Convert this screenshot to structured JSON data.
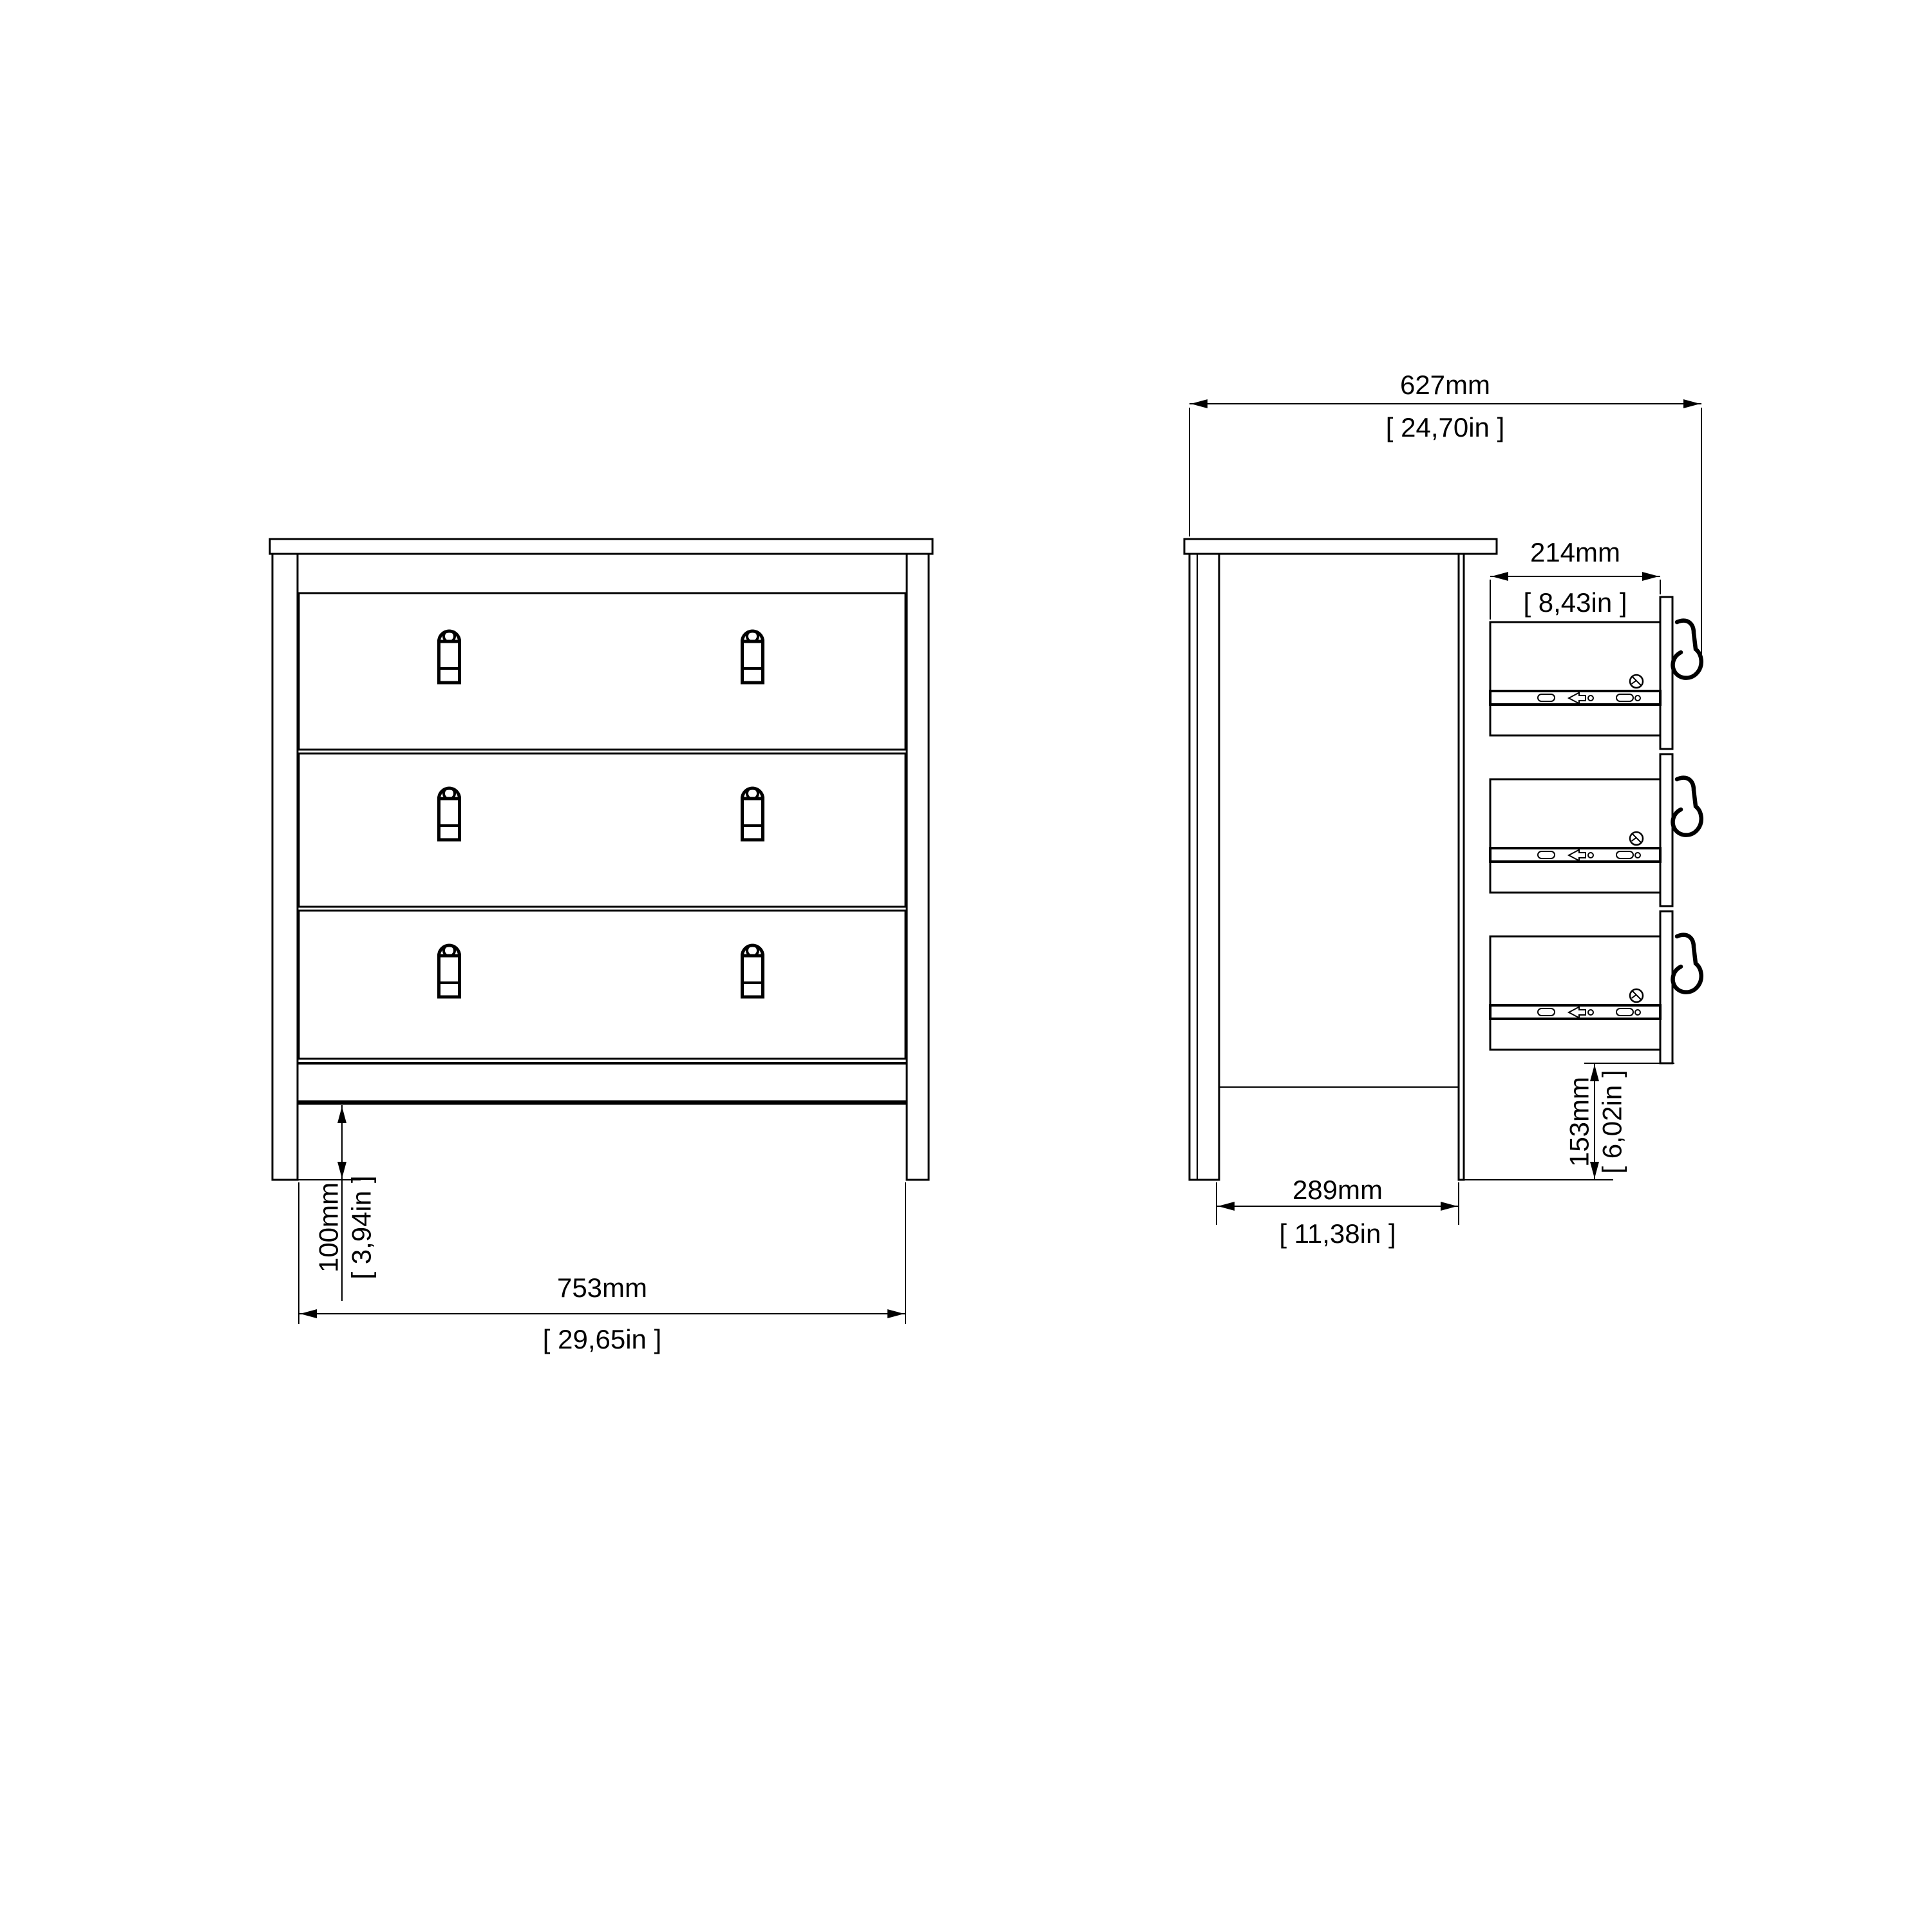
{
  "colors": {
    "ink": "#000000",
    "paper": "#ffffff"
  },
  "front_view": {
    "width": {
      "mm": "753mm",
      "inches": "[ 29,65in ]"
    },
    "plinth_height": {
      "mm": "100mm",
      "inches": "[ 3,94in ]"
    }
  },
  "side_view": {
    "total_depth": {
      "mm": "627mm",
      "inches": "[ 24,70in ]"
    },
    "drawer_extension": {
      "mm": "214mm",
      "inches": "[ 8,43in ]"
    },
    "carcass_depth": {
      "mm": "289mm",
      "inches": "[ 11,38in ]"
    },
    "drawer_front_height": {
      "mm": "153mm",
      "inches": "[ 6,02in ]"
    }
  }
}
